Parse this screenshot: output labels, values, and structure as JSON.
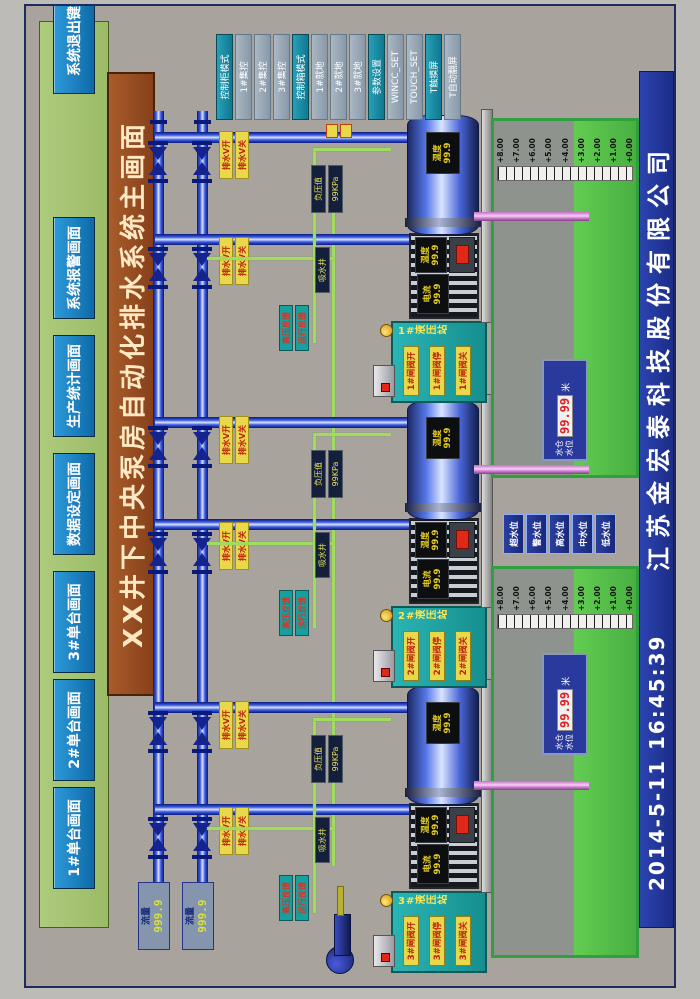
{
  "header": {
    "menu_items": [
      "1#单台画面",
      "2#单台画面",
      "3#单台画面",
      "数据设定画面",
      "生产统计画面",
      "系统报警画面"
    ],
    "exit_button": "系统退出键",
    "title": "XX井下中央泵房自动化排水系统主画面"
  },
  "mode_panel": {
    "buttons": [
      {
        "label": "控制柜模式",
        "accent": true
      },
      {
        "label": "1#集控",
        "accent": false
      },
      {
        "label": "2#集控",
        "accent": false
      },
      {
        "label": "3#集控",
        "accent": false
      },
      {
        "label": "控制箱模式",
        "accent": true
      },
      {
        "label": "1#就地",
        "accent": false
      },
      {
        "label": "2#就地",
        "accent": false
      },
      {
        "label": "3#就地",
        "accent": false
      },
      {
        "label": "参数设置",
        "accent": true
      },
      {
        "label": "WINCC_SET",
        "accent": false
      },
      {
        "label": "TOUCH_SET",
        "accent": false
      },
      {
        "label": "T触摸屏",
        "accent": true
      },
      {
        "label": "T自动翻屏",
        "accent": false
      }
    ]
  },
  "pipelines": [
    {
      "flow_label": "流量",
      "flow_value": "999.9"
    },
    {
      "flow_label": "流量",
      "flow_value": "999.9"
    }
  ],
  "units": [
    {
      "id": "3#",
      "hydraulic_label": "3#液压站",
      "valve_open": "3#闸阀开",
      "valve_stop": "3#闸阀停",
      "valve_close": "3#闸阀关",
      "tag_open": "排水V开",
      "tag_close": "排水V关",
      "fb_hv": "高压反馈",
      "fb_run": "运行反馈",
      "vacuum_label": "负压值",
      "vacuum_value": "99KPa",
      "well_label": "吸水井",
      "current_label": "电流",
      "current_value": "99.9",
      "motor_temp_label": "温度",
      "motor_temp_value": "99.9",
      "pump_temp_label": "温度",
      "pump_temp_value": "99.9"
    },
    {
      "id": "2#",
      "hydraulic_label": "2#液压站",
      "valve_open": "2#闸阀开",
      "valve_stop": "2#闸阀停",
      "valve_close": "2#闸阀关",
      "tag_open": "排水V开",
      "tag_close": "排水V关",
      "fb_hv": "高压反馈",
      "fb_run": "运行反馈",
      "vacuum_label": "负压值",
      "vacuum_value": "99KPa",
      "well_label": "吸水井",
      "current_label": "电流",
      "current_value": "99.9",
      "motor_temp_label": "温度",
      "motor_temp_value": "99.9",
      "pump_temp_label": "温度",
      "pump_temp_value": "99.9"
    },
    {
      "id": "1#",
      "hydraulic_label": "1#液压站",
      "valve_open": "1#闸阀开",
      "valve_stop": "1#闸阀停",
      "valve_close": "1#闸阀关",
      "tag_open": "排水V开",
      "tag_close": "排水V关",
      "fb_hv": "高压反馈",
      "fb_run": "运行反馈",
      "vacuum_label": "负压值",
      "vacuum_value": "99KPa",
      "well_label": "吸水井",
      "current_label": "电流",
      "current_value": "99.9",
      "motor_temp_label": "温度",
      "motor_temp_value": "99.9",
      "pump_temp_label": "温度",
      "pump_temp_value": "99.9"
    }
  ],
  "sumps": [
    {
      "display_label1": "水仓",
      "display_label2": "水位",
      "value": "99.99",
      "unit": "米"
    },
    {
      "display_label1": "水仓",
      "display_label2": "水位",
      "value": "99.99",
      "unit": "米"
    }
  ],
  "level_scale": [
    "+8.00",
    "+7.00",
    "+6.00",
    "+5.00",
    "+4.00",
    "+3.00",
    "+2.00",
    "+1.00",
    "+0.00"
  ],
  "level_buttons": [
    "超水位",
    "警水位",
    "高水位",
    "中水位",
    "低水位"
  ],
  "footer": {
    "datetime": "2014-5-11  16:45:39",
    "company": "江苏金宏泰科技股份有限公司"
  },
  "colors": {
    "menu_green": "#a4c473",
    "button_blue": "#1580c4",
    "title_brown": "#9a5226",
    "footer_blue": "#2438a0",
    "pipe_blue": "#2440c8",
    "signal_green": "#a0dc60",
    "suction_pink": "#d88ad8",
    "water_green": "#55c148",
    "alarm_red": "#e03020",
    "teal": "#18a0a0"
  }
}
